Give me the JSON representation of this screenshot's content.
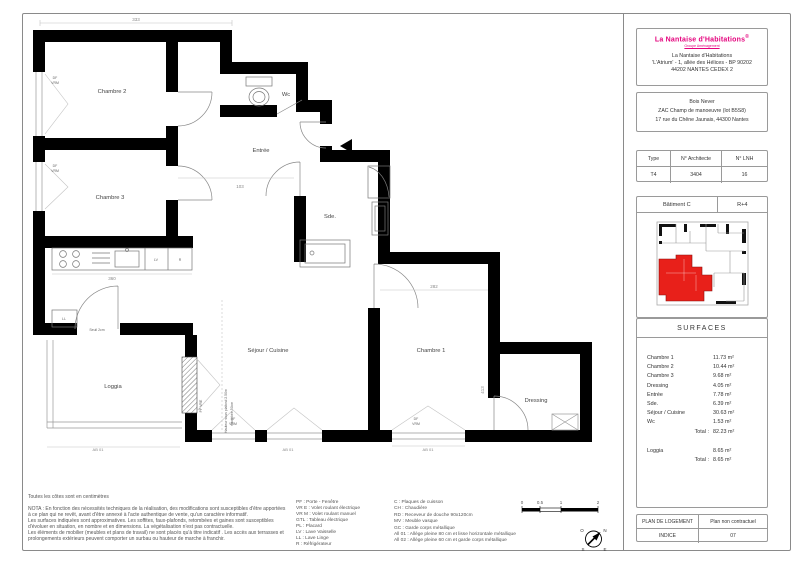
{
  "colors": {
    "brand_magenta": "#e4007c",
    "plan_red": "#e8201a"
  },
  "title_block": {
    "brand": "La Nantaise d'Habitations",
    "brand_mark": "®",
    "brand_sub": "Groupe Aménagement",
    "address_lines": [
      "La Nantaise d'Habitations",
      "'L'Atrium' - 1, allée des Hélices - BP 90202",
      "44202 NANTES CEDEX 2"
    ],
    "program_lines": [
      "Bois Never",
      "ZAC Champ de manoeuvre (lot B5S8)",
      "17 rue du Chêne Jaunais, 44300 Nantes"
    ],
    "ref_table": {
      "col1_header": "Type",
      "col2_header": "N° Architecte",
      "col3_header": "N° LNH",
      "col1_value": "T4",
      "col2_value": "3404",
      "col3_value": "16"
    },
    "building": {
      "name": "Bâtiment C",
      "level": "R+4"
    },
    "surfaces": {
      "title": "SURFACES",
      "rows": [
        {
          "label": "Chambre 1",
          "value": "11.73 m²"
        },
        {
          "label": "Chambre 2",
          "value": "10.44 m²"
        },
        {
          "label": "Chambre 3",
          "value": "9.68 m²"
        },
        {
          "label": "Dressing",
          "value": "4.05 m²"
        },
        {
          "label": "Entrée",
          "value": "7.78 m²"
        },
        {
          "label": "Sde.",
          "value": "6.39 m²"
        },
        {
          "label": "Séjour / Cuisine",
          "value": "30.63 m²"
        },
        {
          "label": "Wc",
          "value": "1.53 m²"
        }
      ],
      "total_label": "Total :",
      "total_value": "82.23 m²",
      "loggia_label": "Loggia",
      "loggia_value": "8.65 m²",
      "loggia_total_label": "Total :",
      "loggia_total_value": "8.65 m²"
    },
    "footer": {
      "plan_label": "PLAN DE LOGEMENT",
      "plan_value": "Plan non contractuel",
      "indice_label": "INDICE",
      "indice_value": "07"
    }
  },
  "plan": {
    "rooms": {
      "chambre2": "Chambre 2",
      "chambre3": "Chambre 3",
      "wc": "Wc",
      "entree": "Entrée",
      "sde": "Sde.",
      "sejour": "Séjour / Cuisine",
      "chambre1": "Chambre 1",
      "dressing": "Dressing",
      "loggia": "Loggia"
    },
    "annotations": {
      "ceiling_line1": "Hauteur sous plafond 2.50m",
      "ceiling_line2": "retombée 50cm",
      "seuil": "Seuil 2cm",
      "pf_vre": "PF VRE",
      "df": "DF",
      "vrm": "VRM",
      "ab01": "AB 01",
      "lv": "LV",
      "r": "R",
      "ll": "LL"
    },
    "dimensions": {
      "top": "333",
      "kitchen": "360",
      "chambre1_width": "282",
      "entree": "103",
      "chambre1_height": "413"
    }
  },
  "notes": {
    "title": "Toutes les côtes sont en centimètres",
    "lines": [
      "NOTA : En fonction des nécessités techniques de la réalisation, des modifications sont susceptibles d'être apportées",
      "à ce plan qui ne revêt, avant d'être annexé à l'acte authentique de vente, qu'un caractère informatif.",
      "Les surfaces indiquées sont approximatives. Les soffites, faux-plafonds, retombées et gaines sont susceptibles",
      "d'évoluer en situation, en nombre et en dimensions. La végétalisation n'est pas contractuelle.",
      "Les éléments de mobilier (meubles et plans de travail) ne sont placés qu'à titre indicatif . Les accès aux terrasses et",
      "prolongements extérieurs peuvent comporter un surbau ou hauteur de marche à franchir."
    ]
  },
  "legend": {
    "col1": [
      "PF : Porte - Fenêtre",
      "VR E : Volet roulant électrique",
      "VR M : Volet roulant manuel",
      "GTL : Tableau électrique",
      "PL : Placard",
      "LV : Lave Vaisselle",
      "LL : Lave Linge",
      "R : Réfrigérateur"
    ],
    "col2": [
      "C : Plaques de cuisson",
      "CH : Chaudière",
      "RD : Receveur de douche 90x120cm",
      "MV : Meuble vasque",
      "GC : Garde corps métallique",
      "All 01 : Allège pleine 80 cm et lisse horizontale métallique",
      "All 02 : Allège pleine 60 cm et garde corps métallique"
    ]
  },
  "scale_bar": {
    "labels": [
      "0",
      "0.5",
      "1",
      "2"
    ]
  },
  "compass": {
    "n": "N",
    "s": "S",
    "e": "E",
    "o": "O"
  }
}
